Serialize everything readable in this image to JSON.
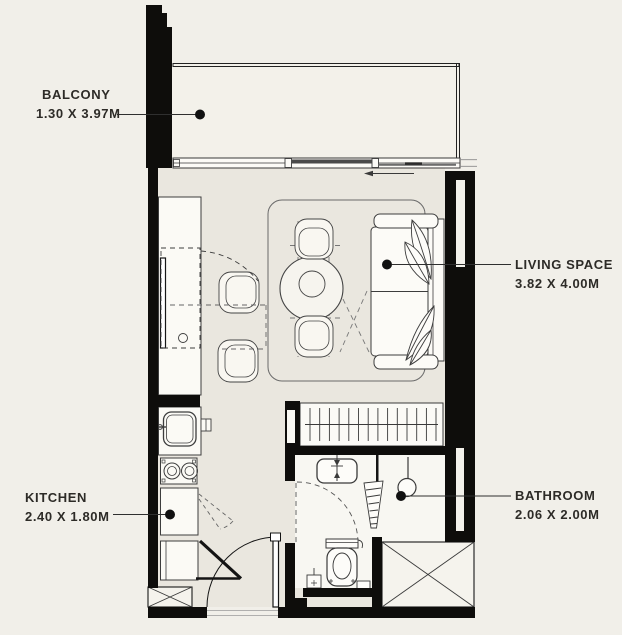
{
  "plan": {
    "type": "apartment-floor-plan",
    "background_color": "#f1efe9",
    "wall_color": "#0e0d0b",
    "text_color": "#2d2b27",
    "labels": [
      {
        "room": "BALCONY",
        "dims": "1.30 X 3.97M",
        "side": "left"
      },
      {
        "room": "LIVING SPACE",
        "dims": "3.82 X 4.00M",
        "side": "right"
      },
      {
        "room": "KITCHEN",
        "dims": "2.40 X 1.80M",
        "side": "left"
      },
      {
        "room": "BATHROOM",
        "dims": "2.06 X 2.00M",
        "side": "right"
      }
    ]
  }
}
